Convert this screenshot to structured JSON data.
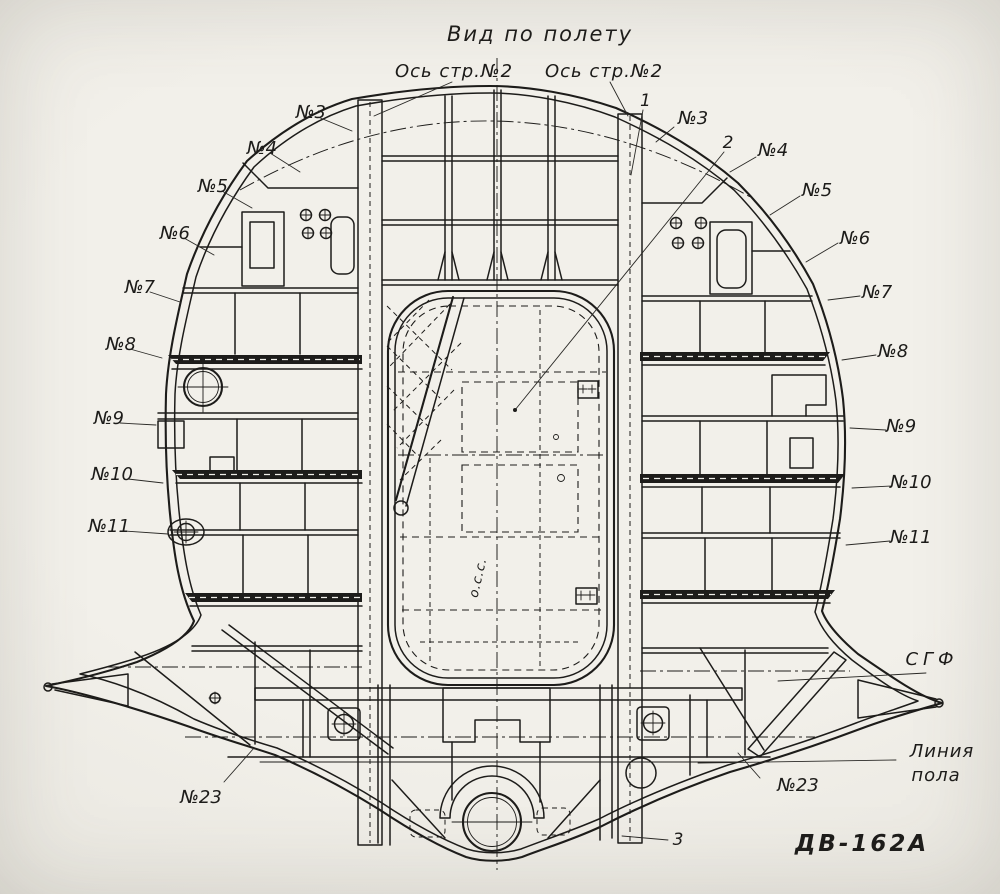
{
  "title": "Вид по полету",
  "axes": {
    "left": "Ось стр.№2",
    "right": "Ось стр.№2"
  },
  "callouts": {
    "one": "1",
    "two": "2",
    "three": "3"
  },
  "frames_left": [
    "№3",
    "№4",
    "№5",
    "№6",
    "№7",
    "№8",
    "№9",
    "№10",
    "№11"
  ],
  "frames_right": [
    "№3",
    "№4",
    "№5",
    "№6",
    "№7",
    "№8",
    "№9",
    "№10",
    "№11"
  ],
  "frame23": {
    "left": "№23",
    "right": "№23"
  },
  "sgf": "СГФ",
  "floor": {
    "line1": "Линия",
    "line2": "пола"
  },
  "center_axis": "о.с.с.",
  "drawing_number": "ДВ-162А",
  "colors": {
    "paper": "#efeee8",
    "ink": "#1d1c1a"
  }
}
